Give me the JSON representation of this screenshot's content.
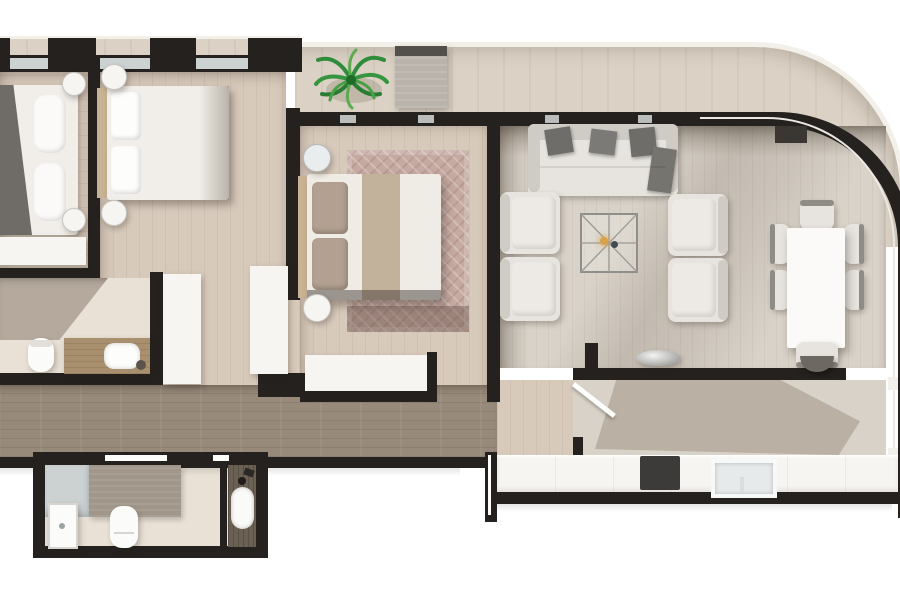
{
  "scene": {
    "type": "apartment-floor-plan-3d-render",
    "text_visible": false,
    "rooms": [
      {
        "id": "bedroom-1",
        "furniture": [
          "double-bed",
          "gray-blanket",
          "pillows",
          "round-nightstand",
          "round-nightstand",
          "white-sideboard"
        ]
      },
      {
        "id": "bedroom-2",
        "furniture": [
          "double-bed",
          "tan-headboard",
          "pillows",
          "round-nightstand",
          "round-nightstand",
          "white-wardrobe",
          "white-closet"
        ]
      },
      {
        "id": "master-bedroom",
        "furniture": [
          "double-bed",
          "tan-headboard",
          "taupe-pillows",
          "bed-runner",
          "patterned-area-rug",
          "round-nightstand",
          "round-nightstand",
          "white-dresser"
        ]
      },
      {
        "id": "bathroom-1",
        "furniture": [
          "walk-in-shower",
          "toilet",
          "wood-vanity",
          "sink",
          "accessory"
        ]
      },
      {
        "id": "bathroom-2",
        "furniture": [
          "shower-enclosure",
          "shower-tray",
          "bath-mat",
          "toilet",
          "dark-wood-vanity",
          "sink",
          "black-faucet"
        ]
      },
      {
        "id": "hallway",
        "furniture": []
      },
      {
        "id": "living-dining-room",
        "furniture": [
          "sofa",
          "throw-pillow",
          "throw-pillow",
          "throw-pillow",
          "chaise-pillow",
          "armchair",
          "armchair",
          "armchair",
          "armchair",
          "lattice-coffee-table",
          "candle",
          "dining-table",
          "dining-chair",
          "dining-chair",
          "dining-chair",
          "dining-chair",
          "dining-chair",
          "dining-chair",
          "decorative-bowl"
        ]
      },
      {
        "id": "kitchen",
        "furniture": [
          "breakfast-bar",
          "base-cabinet-run",
          "cooktop",
          "kitchen-sink",
          "open-interior-door"
        ]
      },
      {
        "id": "terrace",
        "furniture": [
          "potted-palm-plant",
          "sun-lounger"
        ]
      }
    ],
    "architecture": [
      "black-exterior-walls",
      "window-strips",
      "curved-glass-corner-wall",
      "white-parapet-edge",
      "entry-door-pillar"
    ]
  },
  "colors": {
    "wall": "#24211e",
    "wallSoft": "#3a3733",
    "floorLight": "#d8cabb",
    "floorPale": "#d9d2c8",
    "hallFloor": "#988a7a",
    "stone": "#dbd2c5",
    "stoneEdge": "#f3efe9",
    "bathTile": "#e9e1d5",
    "furnWhite": "#f6f5f2",
    "linen": "#f1eee9",
    "blanketGray": "#6f6b66",
    "pillowTaupe": "#b3a090",
    "headboardTan": "#cab394",
    "runnerBeige": "#c2b19b",
    "fabric": "#e7e4df",
    "fabricShade": "#cfccc6",
    "pillowDark": "#6e6d69",
    "rugMain": "#c6a9a1",
    "rugBand": "#8f7b72",
    "woodVanity": "#a8906f",
    "darkVanity": "#6b6054",
    "glass": "#ccd2d2",
    "cooktop": "#3c3b39",
    "sinkSteel": "#e7eaeb",
    "matGray": "#a1968a",
    "shadowTone": "#a79b8d",
    "plantGreen": "#2f8c3a",
    "plantGreenLight": "#5bab4e"
  }
}
